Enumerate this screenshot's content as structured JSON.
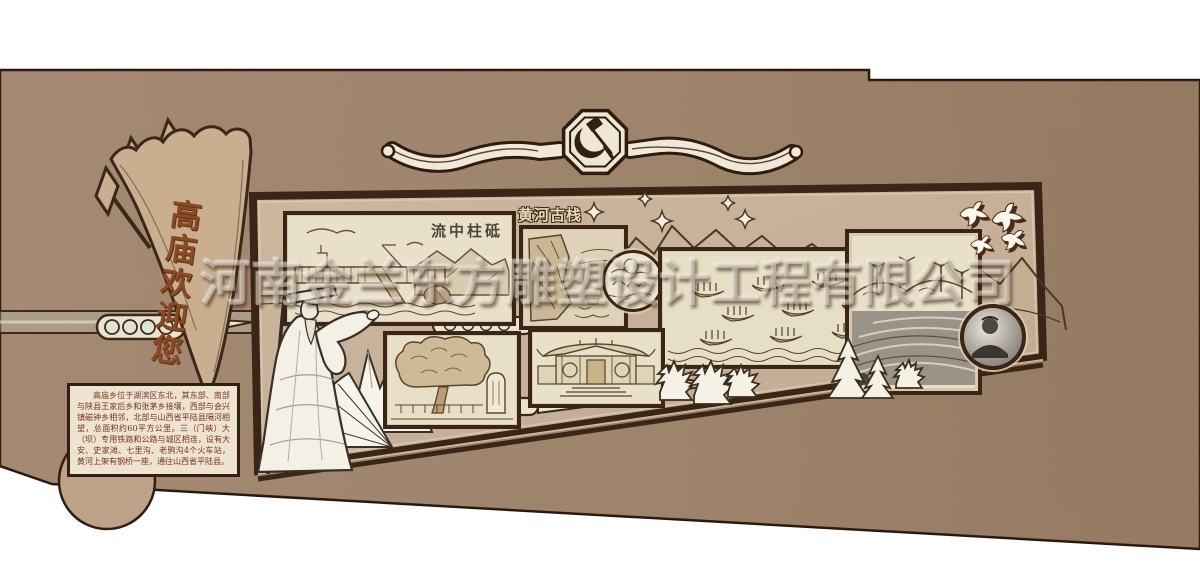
{
  "pennant": {
    "welcome_text": "高庙欢迎您"
  },
  "ribbon_badge": {
    "icon": "hammer-sickle-icon"
  },
  "gallery": {
    "pictures": [
      {
        "name": "dam-scene",
        "caption": "流中柱砥"
      },
      {
        "name": "yellow-river-cliff-scene",
        "title": "黄河古栈"
      },
      {
        "name": "boat-fleet-scene"
      },
      {
        "name": "wind-farm-terraces-scene"
      },
      {
        "name": "ancient-tree-stele-scene"
      },
      {
        "name": "temple-gate-scene"
      }
    ],
    "medallions": [
      {
        "name": "ink-landscape-medallion"
      },
      {
        "name": "portrait-photo-medallion"
      }
    ]
  },
  "info_box": {
    "text": "高庙乡位于湖滨区东北，其东部、南部与陕县王家后乡和张茅乡接壤，西部与会兴镇磁钟乡相邻，北部与山西省平陆县隔河相望，总面积约60平方公里。三（门峡）大（坝）专用铁路和公路与城区相连，设有大安、史家滩、七里沟、老鸦沟4个火车站，黄河上架有钢桥一座，通往山西省平陆县。"
  },
  "watermark": {
    "text": "河南金兰东方雕塑设计工程有限公司"
  },
  "colors": {
    "wall": "#a1876f",
    "panel": "#c9b49b",
    "frame": "#3a2517",
    "cream": "#ece3d0",
    "calligraphy": "#8a4a26",
    "info_text": "#77351c"
  }
}
